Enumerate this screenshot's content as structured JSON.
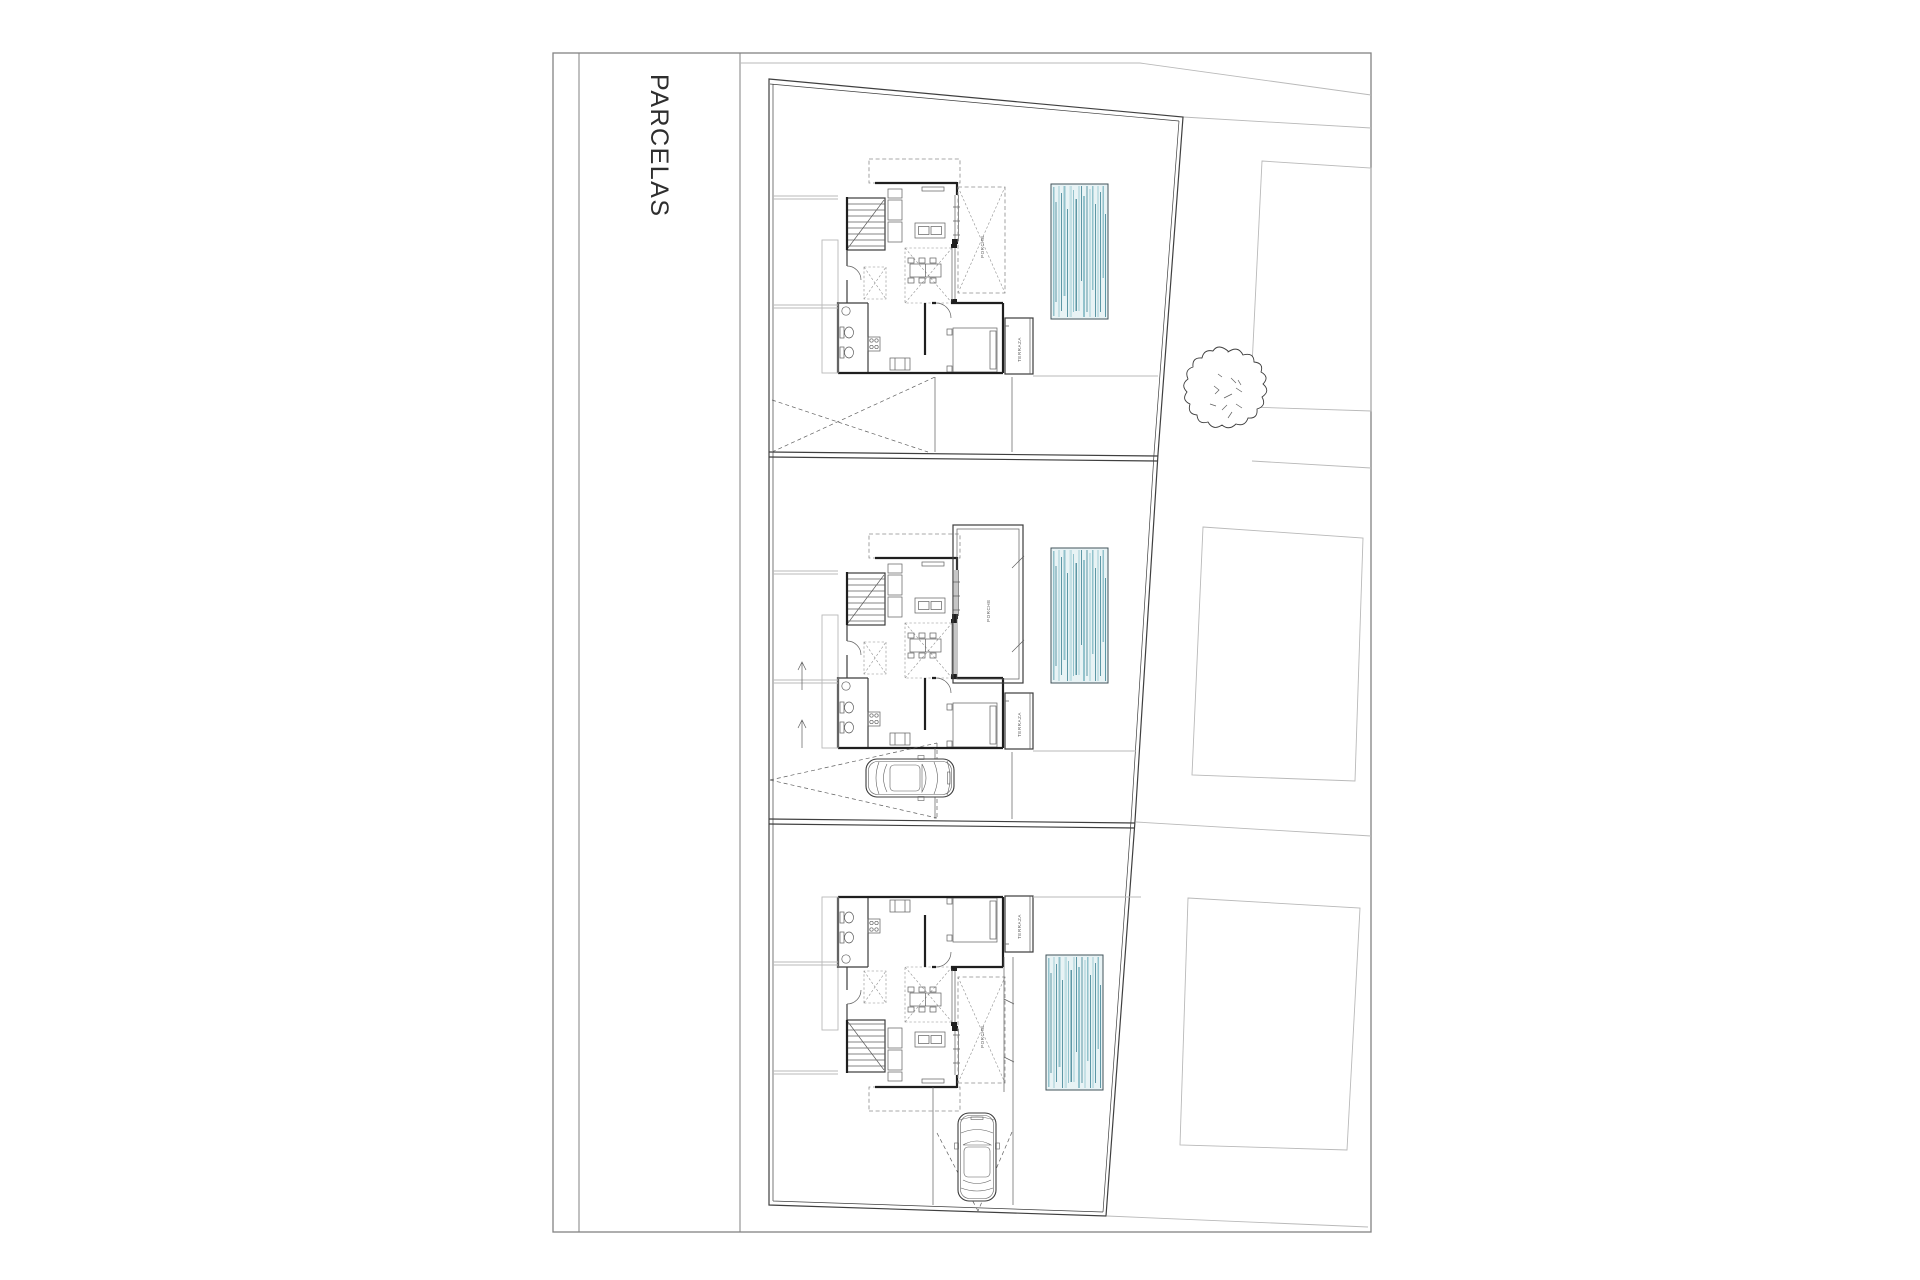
{
  "sheet": {
    "title": "PARCELAS"
  },
  "plan_labels": {
    "porch": "PORCHE",
    "terrace": "TERRAZA"
  },
  "colors": {
    "paper": "#ffffff",
    "frame_line": "#828282",
    "title_text": "#2e2e2e",
    "boundary": "#3f3f3f",
    "ink_heavy": "#1f1f1f",
    "ink_medium": "#3c3c3c",
    "ink_light": "#5f5f5f",
    "gray_line": "#b9b9b9",
    "dash_line": "#8c8c8c",
    "pool_water": "#e8f3f5",
    "pool_border": "#42535a",
    "pool_stripe_light": "#c4e0e5",
    "pool_stripe_mid": "#92c2cc",
    "pool_stripe_dark": "#5d97a5"
  },
  "site": {
    "parcels": [
      {
        "id": 1,
        "position": "top",
        "features": [
          "house-plan",
          "pool",
          "porch",
          "terrace",
          "sight-lines"
        ]
      },
      {
        "id": 2,
        "position": "middle",
        "features": [
          "house-plan",
          "pool",
          "porch",
          "terrace",
          "car",
          "sight-lines"
        ]
      },
      {
        "id": 3,
        "position": "bottom",
        "features": [
          "house-plan-mirrored",
          "pool",
          "porch",
          "terrace",
          "car",
          "sight-lines"
        ]
      }
    ],
    "neighbor_lots": 3,
    "trees": 1,
    "cars": 2,
    "pools": 3
  }
}
